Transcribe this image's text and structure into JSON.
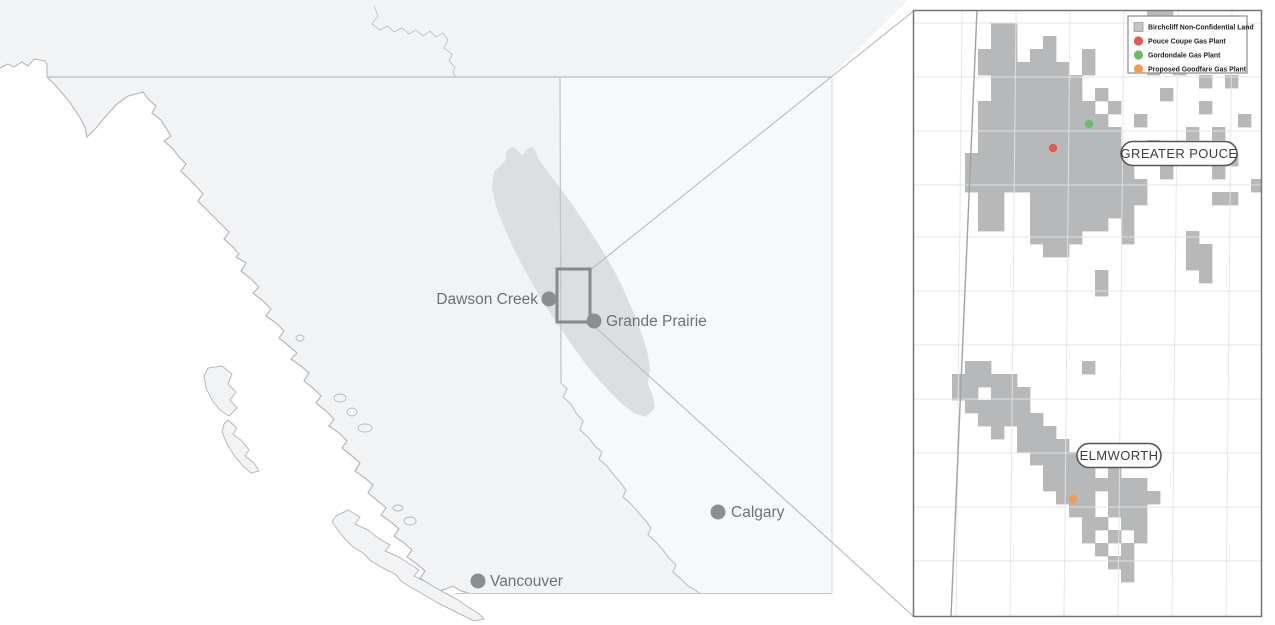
{
  "map": {
    "region_name": "British Columbia / Alberta overview",
    "colors": {
      "bc_fill": "#f2f3f5",
      "ab_fill": "#f7f8f9",
      "play_blob": "#dcdee1",
      "coast_stroke": "#b6b9bc",
      "border_stroke": "#c2c5c8",
      "city_dot": "#8a8d91",
      "zoom_rect": "#85888c",
      "connector": "#b7babd"
    },
    "cities": [
      {
        "name": "Dawson Creek",
        "x": 549,
        "y": 299,
        "lx": 538,
        "ly": 304,
        "anchor": "end"
      },
      {
        "name": "Grande Prairie",
        "x": 594,
        "y": 321,
        "lx": 606,
        "ly": 326,
        "anchor": "start"
      },
      {
        "name": "Calgary",
        "x": 718,
        "y": 512,
        "lx": 731,
        "ly": 517,
        "anchor": "start"
      },
      {
        "name": "Vancouver",
        "x": 478,
        "y": 581,
        "lx": 490,
        "ly": 586,
        "anchor": "start"
      }
    ]
  },
  "inset": {
    "frame": {
      "x": 913,
      "y": 10,
      "w": 349,
      "h": 607
    },
    "colors": {
      "land_cell": "#b6b8ba",
      "grid": "#e3e4e6",
      "ab_border": "#9fa2a5",
      "frame": "#717478"
    },
    "grid": {
      "verticals": [
        962,
        1016,
        1070,
        1124,
        1178,
        1232
      ],
      "vertical_tilt": -6,
      "horizontals": [
        23,
        77,
        131,
        185,
        237,
        291,
        345,
        399,
        453,
        507,
        561
      ]
    },
    "cell_size": 13,
    "area_labels": [
      {
        "text": "GREATER POUCE",
        "cx": 1179,
        "cy": 153.5,
        "w": 116,
        "h": 24
      },
      {
        "text": "ELMWORTH",
        "cx": 1119,
        "cy": 455.5,
        "w": 84,
        "h": 24
      }
    ],
    "plants": [
      {
        "name": "Pouce Coupe Gas Plant",
        "x": 1053,
        "y": 148,
        "color": "#e4584e"
      },
      {
        "name": "Gordondale Gas Plant",
        "x": 1089,
        "y": 124,
        "color": "#68bd6e"
      },
      {
        "name": "Proposed Goodfare Gas Plant",
        "x": 1073,
        "y": 499,
        "color": "#f49a4f"
      }
    ],
    "legend": {
      "x": 1128,
      "y": 16,
      "w": 119,
      "h": 57,
      "items": [
        {
          "label": "Birchcliff Non-Confidential Land",
          "shape": "square",
          "color": "#c3c5c7"
        },
        {
          "label": "Pouce Coupe Gas Plant",
          "shape": "circle",
          "color": "#e4584e"
        },
        {
          "label": "Gordondale Gas Plant",
          "shape": "circle",
          "color": "#68bd6e"
        },
        {
          "label": "Proposed Goodfare Gas Plant",
          "shape": "circle",
          "color": "#f49a4f"
        }
      ]
    },
    "land_cells": [
      [
        18,
        0
      ],
      [
        19,
        0
      ],
      [
        6,
        1
      ],
      [
        7,
        1
      ],
      [
        6,
        2
      ],
      [
        7,
        2
      ],
      [
        10,
        2
      ],
      [
        5,
        3
      ],
      [
        6,
        3
      ],
      [
        7,
        3
      ],
      [
        9,
        3
      ],
      [
        10,
        3
      ],
      [
        13,
        3
      ],
      [
        5,
        4
      ],
      [
        6,
        4
      ],
      [
        7,
        4
      ],
      [
        8,
        4
      ],
      [
        9,
        4
      ],
      [
        10,
        4
      ],
      [
        11,
        4
      ],
      [
        13,
        4
      ],
      [
        18,
        4
      ],
      [
        20,
        4
      ],
      [
        6,
        5
      ],
      [
        7,
        5
      ],
      [
        8,
        5
      ],
      [
        9,
        5
      ],
      [
        10,
        5
      ],
      [
        11,
        5
      ],
      [
        12,
        5
      ],
      [
        22,
        5
      ],
      [
        24,
        5
      ],
      [
        6,
        6
      ],
      [
        7,
        6
      ],
      [
        8,
        6
      ],
      [
        9,
        6
      ],
      [
        10,
        6
      ],
      [
        11,
        6
      ],
      [
        12,
        6
      ],
      [
        14,
        6
      ],
      [
        19,
        6
      ],
      [
        5,
        7
      ],
      [
        6,
        7
      ],
      [
        7,
        7
      ],
      [
        8,
        7
      ],
      [
        9,
        7
      ],
      [
        10,
        7
      ],
      [
        11,
        7
      ],
      [
        12,
        7
      ],
      [
        13,
        7
      ],
      [
        15,
        7
      ],
      [
        22,
        7
      ],
      [
        5,
        8
      ],
      [
        6,
        8
      ],
      [
        7,
        8
      ],
      [
        8,
        8
      ],
      [
        9,
        8
      ],
      [
        10,
        8
      ],
      [
        11,
        8
      ],
      [
        12,
        8
      ],
      [
        13,
        8
      ],
      [
        14,
        8
      ],
      [
        17,
        8
      ],
      [
        25,
        8
      ],
      [
        5,
        9
      ],
      [
        6,
        9
      ],
      [
        7,
        9
      ],
      [
        8,
        9
      ],
      [
        9,
        9
      ],
      [
        10,
        9
      ],
      [
        11,
        9
      ],
      [
        12,
        9
      ],
      [
        13,
        9
      ],
      [
        14,
        9
      ],
      [
        15,
        9
      ],
      [
        21,
        9
      ],
      [
        23,
        9
      ],
      [
        5,
        10
      ],
      [
        6,
        10
      ],
      [
        7,
        10
      ],
      [
        8,
        10
      ],
      [
        9,
        10
      ],
      [
        10,
        10
      ],
      [
        11,
        10
      ],
      [
        12,
        10
      ],
      [
        13,
        10
      ],
      [
        14,
        10
      ],
      [
        15,
        10
      ],
      [
        18,
        10
      ],
      [
        4,
        11
      ],
      [
        5,
        11
      ],
      [
        6,
        11
      ],
      [
        7,
        11
      ],
      [
        8,
        11
      ],
      [
        9,
        11
      ],
      [
        10,
        11
      ],
      [
        11,
        11
      ],
      [
        12,
        11
      ],
      [
        13,
        11
      ],
      [
        14,
        11
      ],
      [
        15,
        11
      ],
      [
        16,
        11
      ],
      [
        24,
        11
      ],
      [
        4,
        12
      ],
      [
        5,
        12
      ],
      [
        6,
        12
      ],
      [
        7,
        12
      ],
      [
        8,
        12
      ],
      [
        9,
        12
      ],
      [
        10,
        12
      ],
      [
        11,
        12
      ],
      [
        12,
        12
      ],
      [
        13,
        12
      ],
      [
        14,
        12
      ],
      [
        15,
        12
      ],
      [
        16,
        12
      ],
      [
        19,
        12
      ],
      [
        23,
        12
      ],
      [
        4,
        13
      ],
      [
        5,
        13
      ],
      [
        6,
        13
      ],
      [
        7,
        13
      ],
      [
        8,
        13
      ],
      [
        9,
        13
      ],
      [
        10,
        13
      ],
      [
        11,
        13
      ],
      [
        12,
        13
      ],
      [
        13,
        13
      ],
      [
        14,
        13
      ],
      [
        15,
        13
      ],
      [
        16,
        13
      ],
      [
        17,
        13
      ],
      [
        26,
        13
      ],
      [
        5,
        14
      ],
      [
        6,
        14
      ],
      [
        9,
        14
      ],
      [
        10,
        14
      ],
      [
        11,
        14
      ],
      [
        12,
        14
      ],
      [
        13,
        14
      ],
      [
        14,
        14
      ],
      [
        15,
        14
      ],
      [
        16,
        14
      ],
      [
        17,
        14
      ],
      [
        23,
        14
      ],
      [
        24,
        14
      ],
      [
        5,
        15
      ],
      [
        6,
        15
      ],
      [
        9,
        15
      ],
      [
        10,
        15
      ],
      [
        11,
        15
      ],
      [
        12,
        15
      ],
      [
        13,
        15
      ],
      [
        14,
        15
      ],
      [
        15,
        15
      ],
      [
        16,
        15
      ],
      [
        5,
        16
      ],
      [
        6,
        16
      ],
      [
        9,
        16
      ],
      [
        10,
        16
      ],
      [
        11,
        16
      ],
      [
        12,
        16
      ],
      [
        13,
        16
      ],
      [
        14,
        16
      ],
      [
        16,
        16
      ],
      [
        9,
        17
      ],
      [
        10,
        17
      ],
      [
        11,
        17
      ],
      [
        12,
        17
      ],
      [
        16,
        17
      ],
      [
        21,
        17
      ],
      [
        10,
        18
      ],
      [
        11,
        18
      ],
      [
        21,
        18
      ],
      [
        22,
        18
      ],
      [
        21,
        19
      ],
      [
        22,
        19
      ],
      [
        14,
        20
      ],
      [
        22,
        20
      ],
      [
        14,
        21
      ],
      [
        4,
        27
      ],
      [
        5,
        27
      ],
      [
        13,
        27
      ],
      [
        3,
        28
      ],
      [
        4,
        28
      ],
      [
        5,
        28
      ],
      [
        6,
        28
      ],
      [
        7,
        28
      ],
      [
        3,
        29
      ],
      [
        4,
        29
      ],
      [
        6,
        29
      ],
      [
        7,
        29
      ],
      [
        8,
        29
      ],
      [
        4,
        30
      ],
      [
        5,
        30
      ],
      [
        6,
        30
      ],
      [
        7,
        30
      ],
      [
        8,
        30
      ],
      [
        5,
        31
      ],
      [
        6,
        31
      ],
      [
        7,
        31
      ],
      [
        8,
        31
      ],
      [
        9,
        31
      ],
      [
        6,
        32
      ],
      [
        8,
        32
      ],
      [
        9,
        32
      ],
      [
        10,
        32
      ],
      [
        8,
        33
      ],
      [
        9,
        33
      ],
      [
        10,
        33
      ],
      [
        11,
        33
      ],
      [
        9,
        34
      ],
      [
        10,
        34
      ],
      [
        11,
        34
      ],
      [
        12,
        34
      ],
      [
        10,
        35
      ],
      [
        11,
        35
      ],
      [
        12,
        35
      ],
      [
        13,
        35
      ],
      [
        15,
        35
      ],
      [
        10,
        36
      ],
      [
        11,
        36
      ],
      [
        12,
        36
      ],
      [
        13,
        36
      ],
      [
        14,
        36
      ],
      [
        15,
        36
      ],
      [
        16,
        36
      ],
      [
        17,
        36
      ],
      [
        11,
        37
      ],
      [
        12,
        37
      ],
      [
        13,
        37
      ],
      [
        15,
        37
      ],
      [
        16,
        37
      ],
      [
        17,
        37
      ],
      [
        18,
        37
      ],
      [
        12,
        38
      ],
      [
        13,
        38
      ],
      [
        15,
        38
      ],
      [
        16,
        38
      ],
      [
        17,
        38
      ],
      [
        13,
        39
      ],
      [
        14,
        39
      ],
      [
        16,
        39
      ],
      [
        17,
        39
      ],
      [
        13,
        40
      ],
      [
        15,
        40
      ],
      [
        17,
        40
      ],
      [
        14,
        41
      ],
      [
        16,
        41
      ],
      [
        15,
        42
      ],
      [
        16,
        42
      ],
      [
        16,
        43
      ]
    ]
  }
}
